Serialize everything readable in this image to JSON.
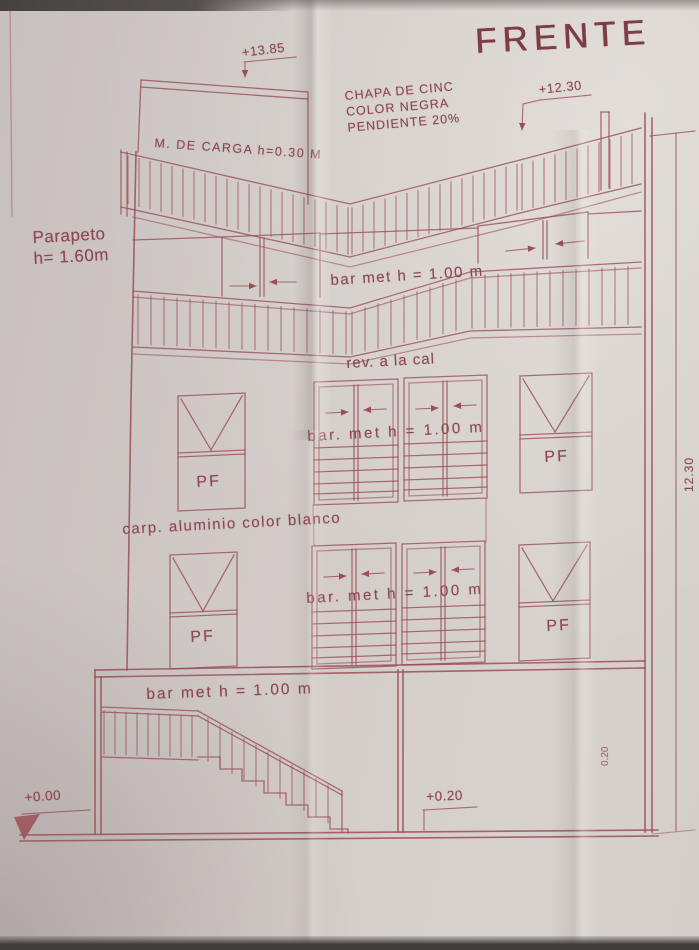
{
  "colors": {
    "ink": "#9a4f57",
    "paper": "#d0c9c6"
  },
  "title": "FRENTE",
  "levels": {
    "bulkhead_top": "+13.85",
    "roof_right": "+12.30",
    "ground_zero": "+0.00",
    "entry": "+0.20"
  },
  "notes": {
    "roof_line1": "CHAPA DE CINC",
    "roof_line2": "COLOR NEGRA",
    "roof_line3": "PENDIENTE 20%",
    "load_wall": "M. DE CARGA h=0.30 M",
    "parapet_line1": "Parapeto",
    "parapet_line2": "h= 1.60m",
    "railing_roof_terrace": "bar met h = 1.00 m",
    "finish_lime": "rev. a la cal",
    "railing_floor2": "bar. met h = 1.00 m",
    "carpentry": "carp. aluminio color blanco",
    "railing_floor1": "bar. met h = 1.00 m",
    "railing_ground": "bar met h = 1.00 m",
    "fixed_panel": "PF"
  },
  "dimensions": {
    "total_height": "12.30",
    "wall_thickness": "0.20"
  }
}
